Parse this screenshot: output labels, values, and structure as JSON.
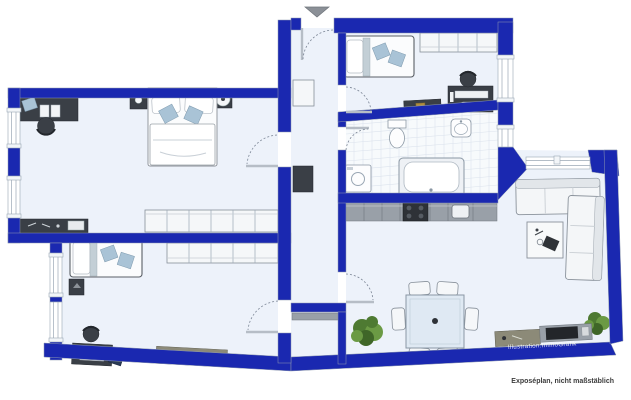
{
  "meta": {
    "caption": "Exposéplan, nicht maßstäblich",
    "watermark": "Illustration:ImmoGrafik"
  },
  "colors": {
    "wall": "#1a28b0",
    "floor": "#edf2fa",
    "tile": "#f7fafc",
    "tile_line": "#dce3ed",
    "furniture_dark": "#3a3f46",
    "furniture_gray": "#99a0a8",
    "wood": "#8c8a78",
    "pillow_blue": "#a9c3d6",
    "sofa_white": "#f4f6f8",
    "plant": "#55803a",
    "arrow": "#8b9097",
    "caption": "#3b3b3b",
    "watermark_text": "#ffffff"
  },
  "icons": {
    "entrance_arrow": "triangle-down",
    "plant": "green-foliage-cluster",
    "door_swing": "dotted-quarter-arc",
    "window": "double-line-band"
  }
}
